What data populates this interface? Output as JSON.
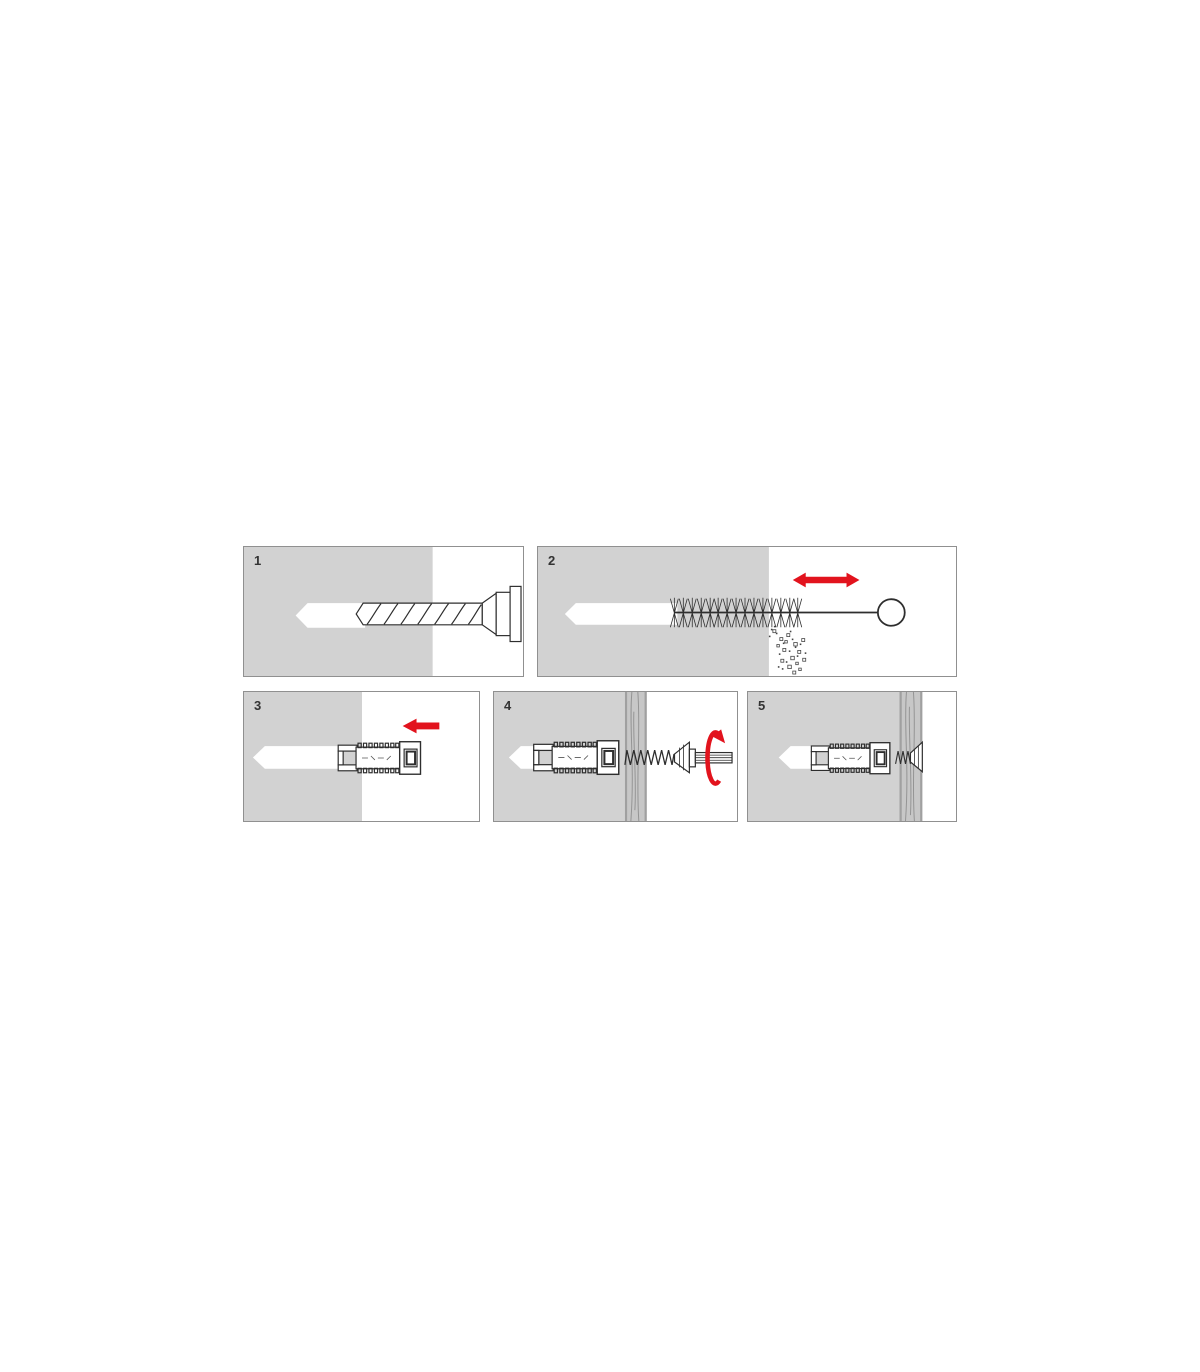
{
  "title": "wall-plug-installation-steps",
  "colors": {
    "accent_red": "#e2131d",
    "wall_gray": "#d2d2d2",
    "board_gray": "#c7c7c7",
    "outline": "#2e2e2e",
    "panel_border": "#909090",
    "number_color": "#333333"
  },
  "panels": [
    {
      "number": "1",
      "icon": "drill-icon"
    },
    {
      "number": "2",
      "icon": "cleaning-brush-icon"
    },
    {
      "number": "3",
      "icon": "wall-plug-icon"
    },
    {
      "number": "4",
      "icon": "screw-driving-icon"
    },
    {
      "number": "5",
      "icon": "flush-screw-icon"
    }
  ]
}
